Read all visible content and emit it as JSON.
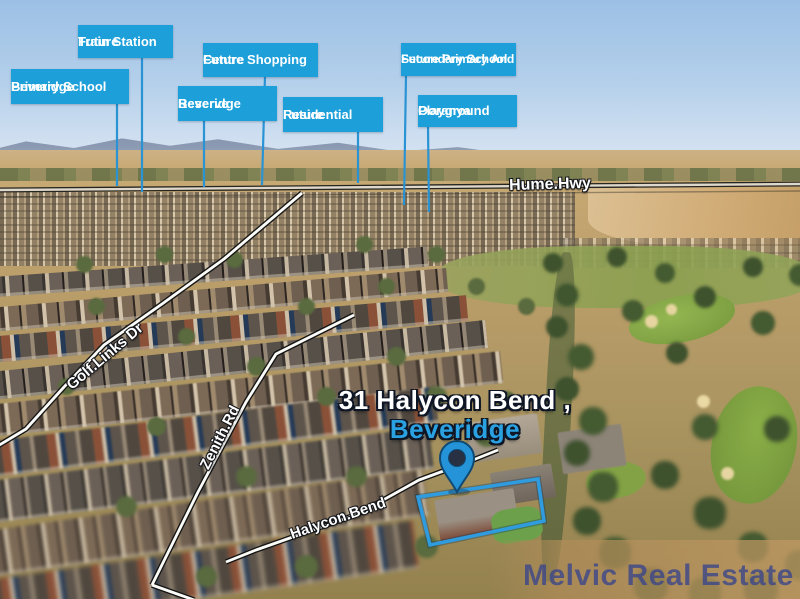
{
  "callouts": [
    {
      "id": "future-train-station",
      "line1": "Future",
      "line2": "Train Station"
    },
    {
      "id": "beveridge-primary-school",
      "line1": "Beveridge",
      "line2": "Primary School"
    },
    {
      "id": "future-shopping-centre",
      "line1": "Future Shopping",
      "line2": "Centre"
    },
    {
      "id": "beveridge-reserve",
      "line1": "Beveridge",
      "line2": "Reserve"
    },
    {
      "id": "future-residential",
      "line1": "Future",
      "line2": "Residential"
    },
    {
      "id": "future-primary-secondary-school",
      "line1": "Future Primary And",
      "line2": "Secondary School"
    },
    {
      "id": "ooranya-playground",
      "line1": "Ooranya",
      "line2": "Playground"
    }
  ],
  "road_labels": {
    "highway": "Hume.Hwy",
    "golf_links": "Golf.Links Dr",
    "zenith": "Zenith.Rd",
    "halycon": "Halycon.Bend"
  },
  "property": {
    "address": "31 Halycon Bend ,",
    "suburb": "Beveridge"
  },
  "watermark": "Melvic Real Estate",
  "colors": {
    "callout_bg": "#1d9fda",
    "leader_line": "#2a93d4",
    "suburb_text": "#2aa2e2",
    "pin": "#2593d8",
    "boundary": "#2f9ce0",
    "watermark": "#38448c"
  }
}
